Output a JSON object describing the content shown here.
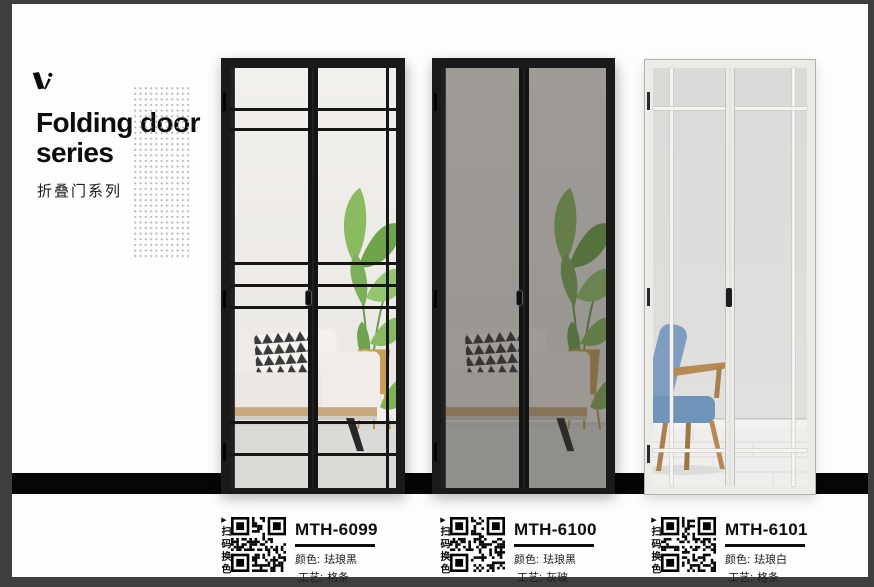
{
  "page": {
    "background_color": "#3f3f3f",
    "card_color": "#fdfdfd",
    "floor_strip_color": "#060606"
  },
  "header": {
    "title_line1": "Folding door",
    "title_line2": "series",
    "subtitle": "折叠门系列"
  },
  "qr": {
    "arrow": "▶",
    "caption": "扫码换色"
  },
  "products": [
    {
      "model": "MTH-6099",
      "color_label": "颜色:",
      "color": "珐琅黑",
      "craft_label": "工艺:",
      "craft": "格条",
      "frame_color": "#1b1b1b"
    },
    {
      "model": "MTH-6100",
      "color_label": "颜色:",
      "color": "珐琅黑",
      "craft_label": "工艺:",
      "craft": "灰玻",
      "frame_color": "#1b1b1b"
    },
    {
      "model": "MTH-6101",
      "color_label": "颜色:",
      "color": "珐琅白",
      "craft_label": "工艺:",
      "craft": "格条",
      "frame_color": "#ebebeb"
    }
  ]
}
